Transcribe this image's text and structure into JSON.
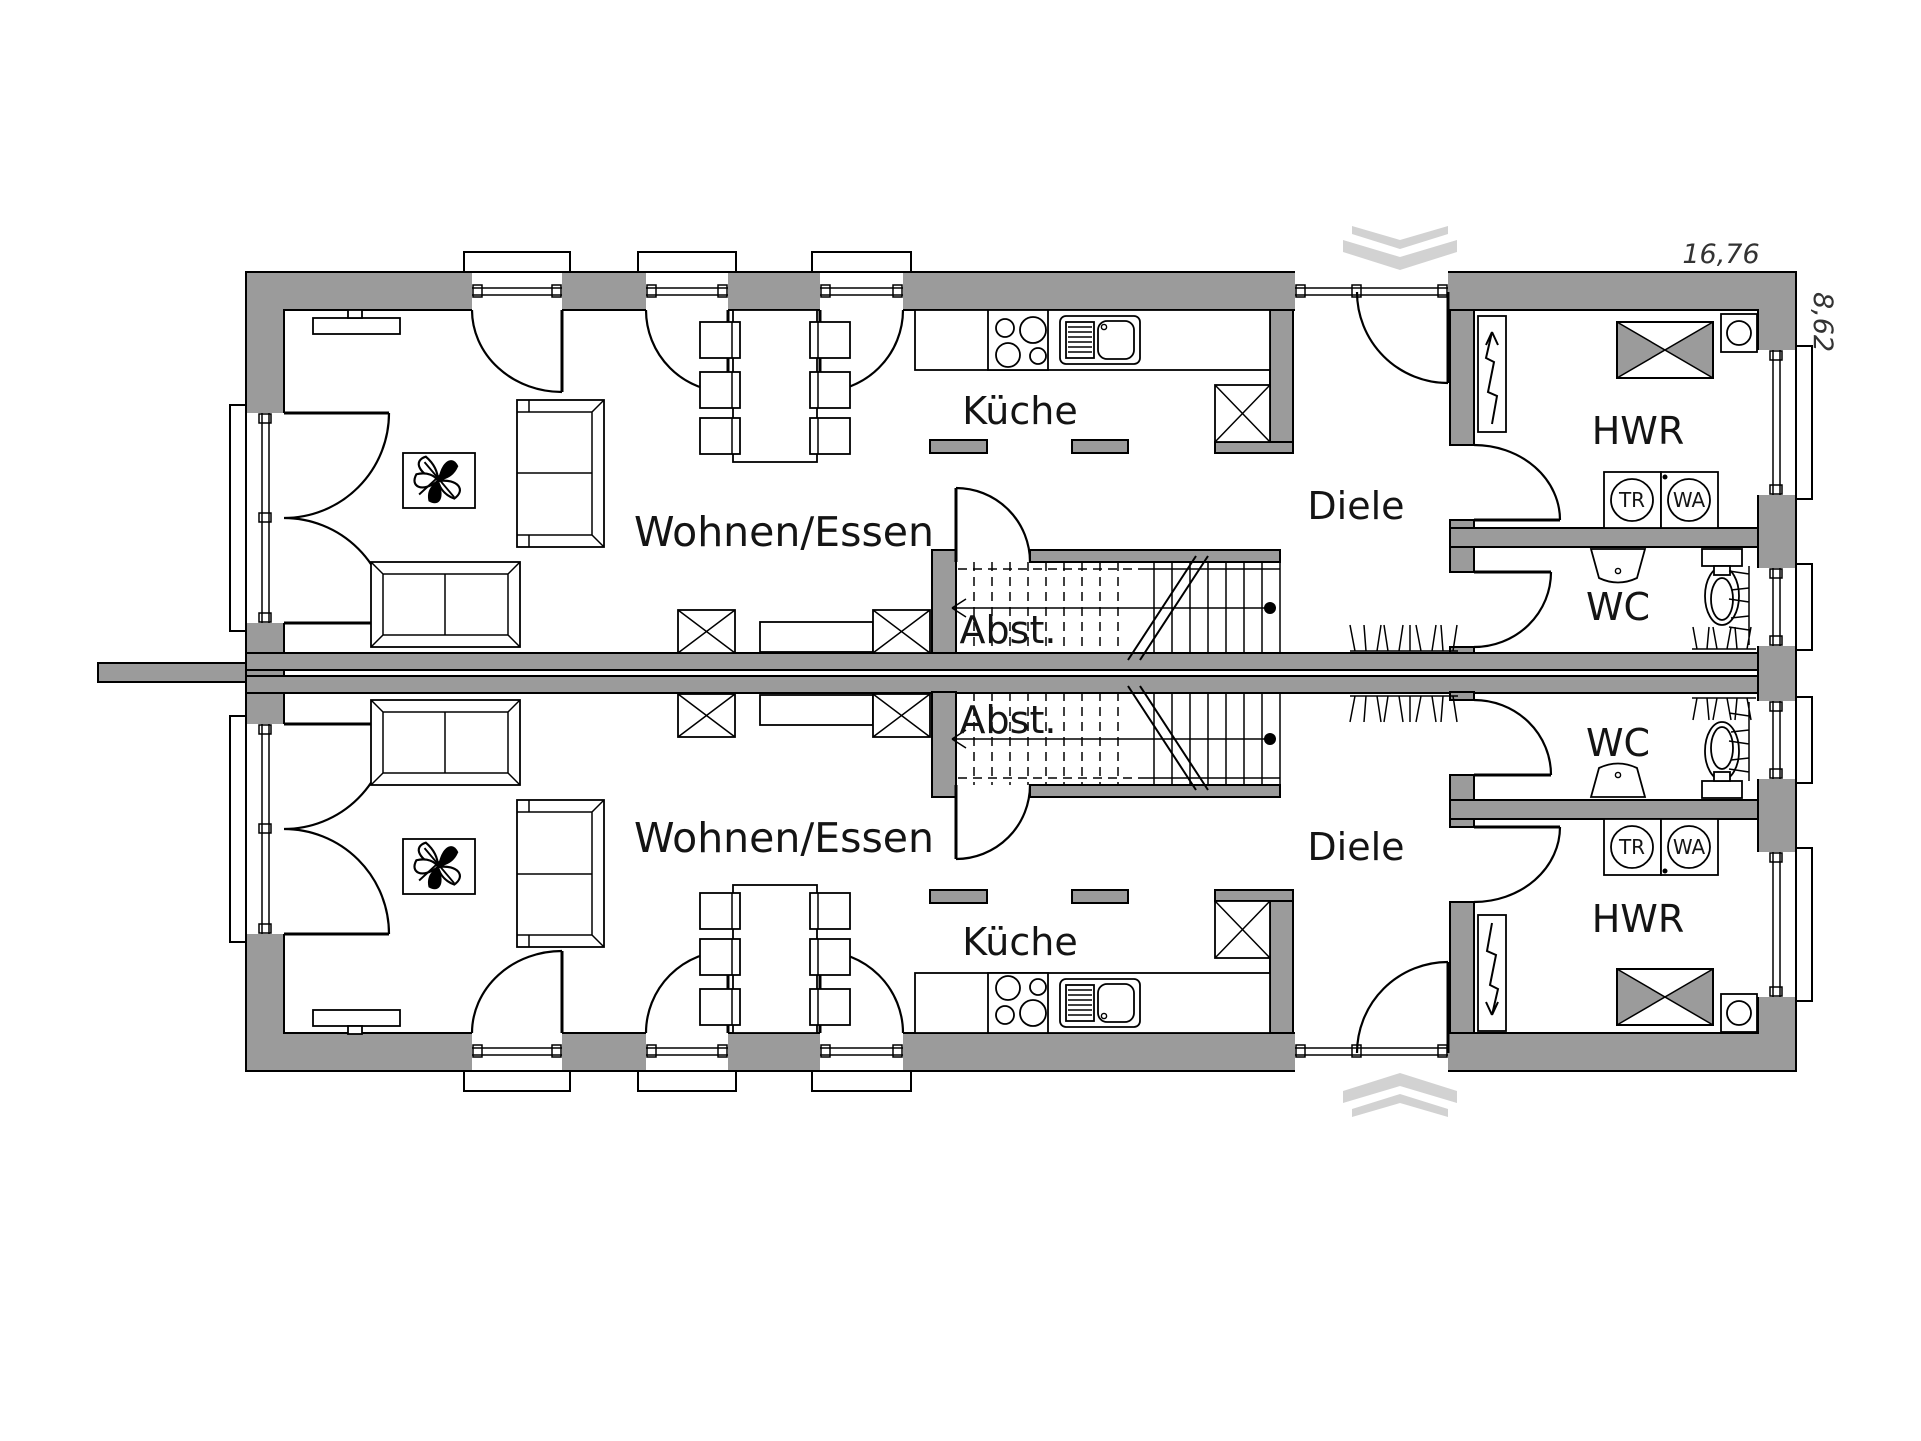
{
  "colors": {
    "wall": "#9b9b9b",
    "line": "#000000",
    "chevron": "#d2d2d2",
    "paper": "#ffffff"
  },
  "dimensions": {
    "width": "16,76",
    "depth": "8,62"
  },
  "units": {
    "top": {
      "living": "Wohnen/Essen",
      "kitchen": "Küche",
      "hall": "Diele",
      "storage": "Abst.",
      "utility": "HWR",
      "wc": "WC",
      "dryer": "TR",
      "washer": "WA"
    },
    "bottom": {
      "living": "Wohnen/Essen",
      "kitchen": "Küche",
      "hall": "Diele",
      "storage": "Abst.",
      "utility": "HWR",
      "wc": "WC",
      "dryer": "TR",
      "washer": "WA"
    }
  }
}
